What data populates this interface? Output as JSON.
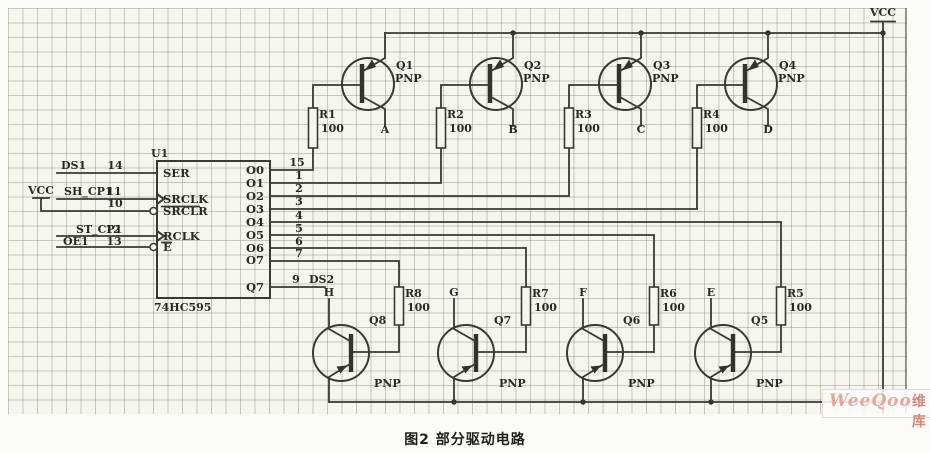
{
  "figure": {
    "caption": "图2  部分驱动电路"
  },
  "watermark": {
    "brand": "WeeQoo",
    "suffix": "维库"
  },
  "power": {
    "vcc_top": "VCC",
    "vcc_left": "VCC"
  },
  "ic": {
    "ref": "U1",
    "part": "74HC595",
    "pins_left": [
      {
        "net": "DS1",
        "num": "14",
        "label": "SER"
      },
      {
        "net": "SH_CP1",
        "num": "11",
        "label": "SRCLK"
      },
      {
        "net": "",
        "num": "10",
        "label": "SRCLR"
      },
      {
        "net": "ST_CP1",
        "num": "12",
        "label": "RCLK"
      },
      {
        "net": "OE1",
        "num": "13",
        "label": "E"
      }
    ],
    "pins_right": [
      {
        "label": "O0",
        "num": "15"
      },
      {
        "label": "O1",
        "num": "1"
      },
      {
        "label": "O2",
        "num": "2"
      },
      {
        "label": "O3",
        "num": "3"
      },
      {
        "label": "O4",
        "num": "4"
      },
      {
        "label": "O5",
        "num": "5"
      },
      {
        "label": "O6",
        "num": "6"
      },
      {
        "label": "O7",
        "num": "7"
      },
      {
        "label": "Q7",
        "num": "9",
        "net": "DS2"
      }
    ]
  },
  "drivers_top": [
    {
      "ref": "Q1",
      "type": "PNP",
      "net": "A",
      "res_ref": "R1",
      "res_val": "100"
    },
    {
      "ref": "Q2",
      "type": "PNP",
      "net": "B",
      "res_ref": "R2",
      "res_val": "100"
    },
    {
      "ref": "Q3",
      "type": "PNP",
      "net": "C",
      "res_ref": "R3",
      "res_val": "100"
    },
    {
      "ref": "Q4",
      "type": "PNP",
      "net": "D",
      "res_ref": "R4",
      "res_val": "100"
    }
  ],
  "drivers_bottom": [
    {
      "ref": "Q8",
      "type": "PNP",
      "net": "H",
      "res_ref": "R8",
      "res_val": "100"
    },
    {
      "ref": "Q7",
      "type": "PNP",
      "net": "G",
      "res_ref": "R7",
      "res_val": "100"
    },
    {
      "ref": "Q6",
      "type": "PNP",
      "net": "F",
      "res_ref": "R6",
      "res_val": "100"
    },
    {
      "ref": "Q5",
      "type": "PNP",
      "net": "E",
      "res_ref": "R5",
      "res_val": "100"
    }
  ]
}
